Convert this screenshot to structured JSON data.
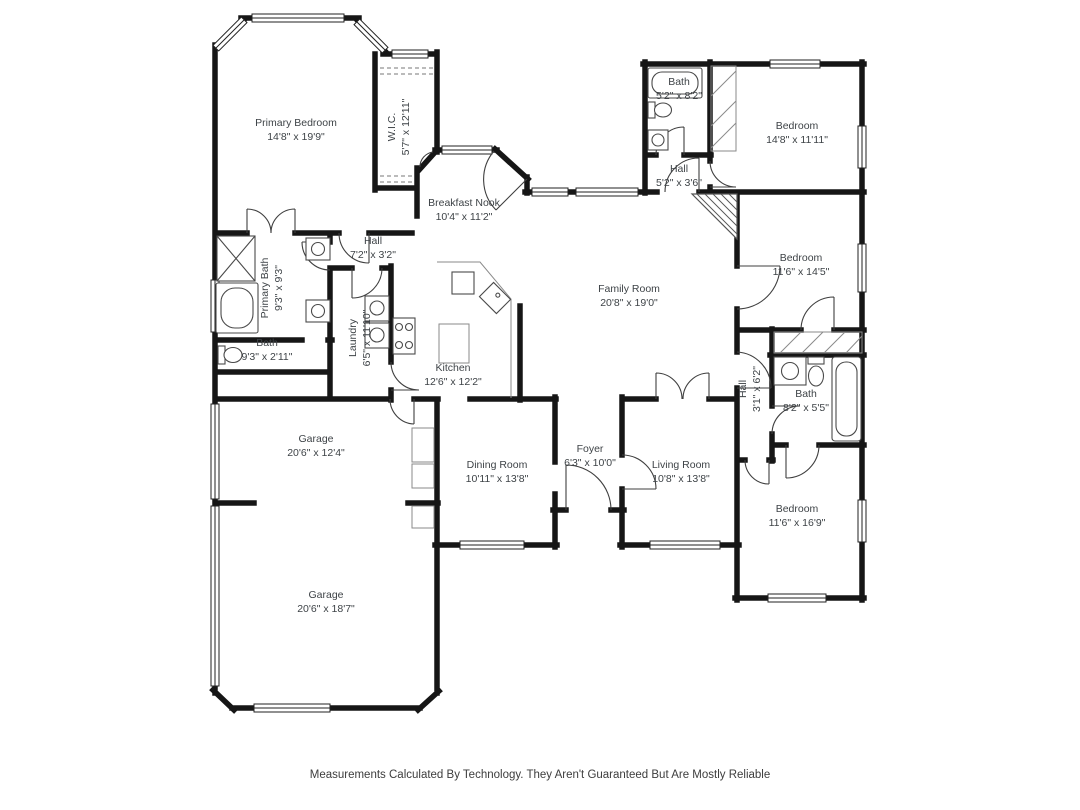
{
  "footer": {
    "disclaimer": "Measurements Calculated By Technology. They Aren't Guaranteed But Are Mostly Reliable"
  },
  "floorplan": {
    "colors": {
      "wall": "#161616",
      "label": "#3e4347"
    },
    "rooms": [
      {
        "id": "primary-bedroom",
        "name": "Primary Bedroom",
        "dims": "14'8\" x 19'9\""
      },
      {
        "id": "walk-in-closet",
        "name": "W.I.C.",
        "dims": "5'7\" x 12'11\""
      },
      {
        "id": "bath-top",
        "name": "Bath",
        "dims": "5'2\" x 8'2\""
      },
      {
        "id": "bedroom-top-right",
        "name": "Bedroom",
        "dims": "14'8\" x 11'11\""
      },
      {
        "id": "hall-top-right",
        "name": "Hall",
        "dims": "5'2\" x 3'6\""
      },
      {
        "id": "breakfast-nook",
        "name": "Breakfast Nook",
        "dims": "10'4\" x 11'2\""
      },
      {
        "id": "hall-left",
        "name": "Hall",
        "dims": "7'2\" x 3'2\""
      },
      {
        "id": "primary-bath",
        "name": "Primary Bath",
        "dims": "9'3\" x 9'3\""
      },
      {
        "id": "bedroom-right",
        "name": "Bedroom",
        "dims": "11'6\" x 14'5\""
      },
      {
        "id": "family-room",
        "name": "Family Room",
        "dims": "20'8\" x 19'0\""
      },
      {
        "id": "laundry",
        "name": "Laundry",
        "dims": "6'5\" x 11'10\""
      },
      {
        "id": "bath-left",
        "name": "Bath",
        "dims": "9'3\" x 2'11\""
      },
      {
        "id": "kitchen",
        "name": "Kitchen",
        "dims": "12'6\" x 12'2\""
      },
      {
        "id": "hall-right",
        "name": "Hall",
        "dims": "3'1\" x 6'2\""
      },
      {
        "id": "bath-right",
        "name": "Bath",
        "dims": "8'2\" x 5'5\""
      },
      {
        "id": "garage-upper",
        "name": "Garage",
        "dims": "20'6\" x 12'4\""
      },
      {
        "id": "dining-room",
        "name": "Dining Room",
        "dims": "10'11\" x 13'8\""
      },
      {
        "id": "foyer",
        "name": "Foyer",
        "dims": "6'3\" x 10'0\""
      },
      {
        "id": "living-room",
        "name": "Living Room",
        "dims": "10'8\" x 13'8\""
      },
      {
        "id": "bedroom-bottom-right",
        "name": "Bedroom",
        "dims": "11'6\" x 16'9\""
      },
      {
        "id": "garage-lower",
        "name": "Garage",
        "dims": "20'6\" x 18'7\""
      }
    ]
  }
}
